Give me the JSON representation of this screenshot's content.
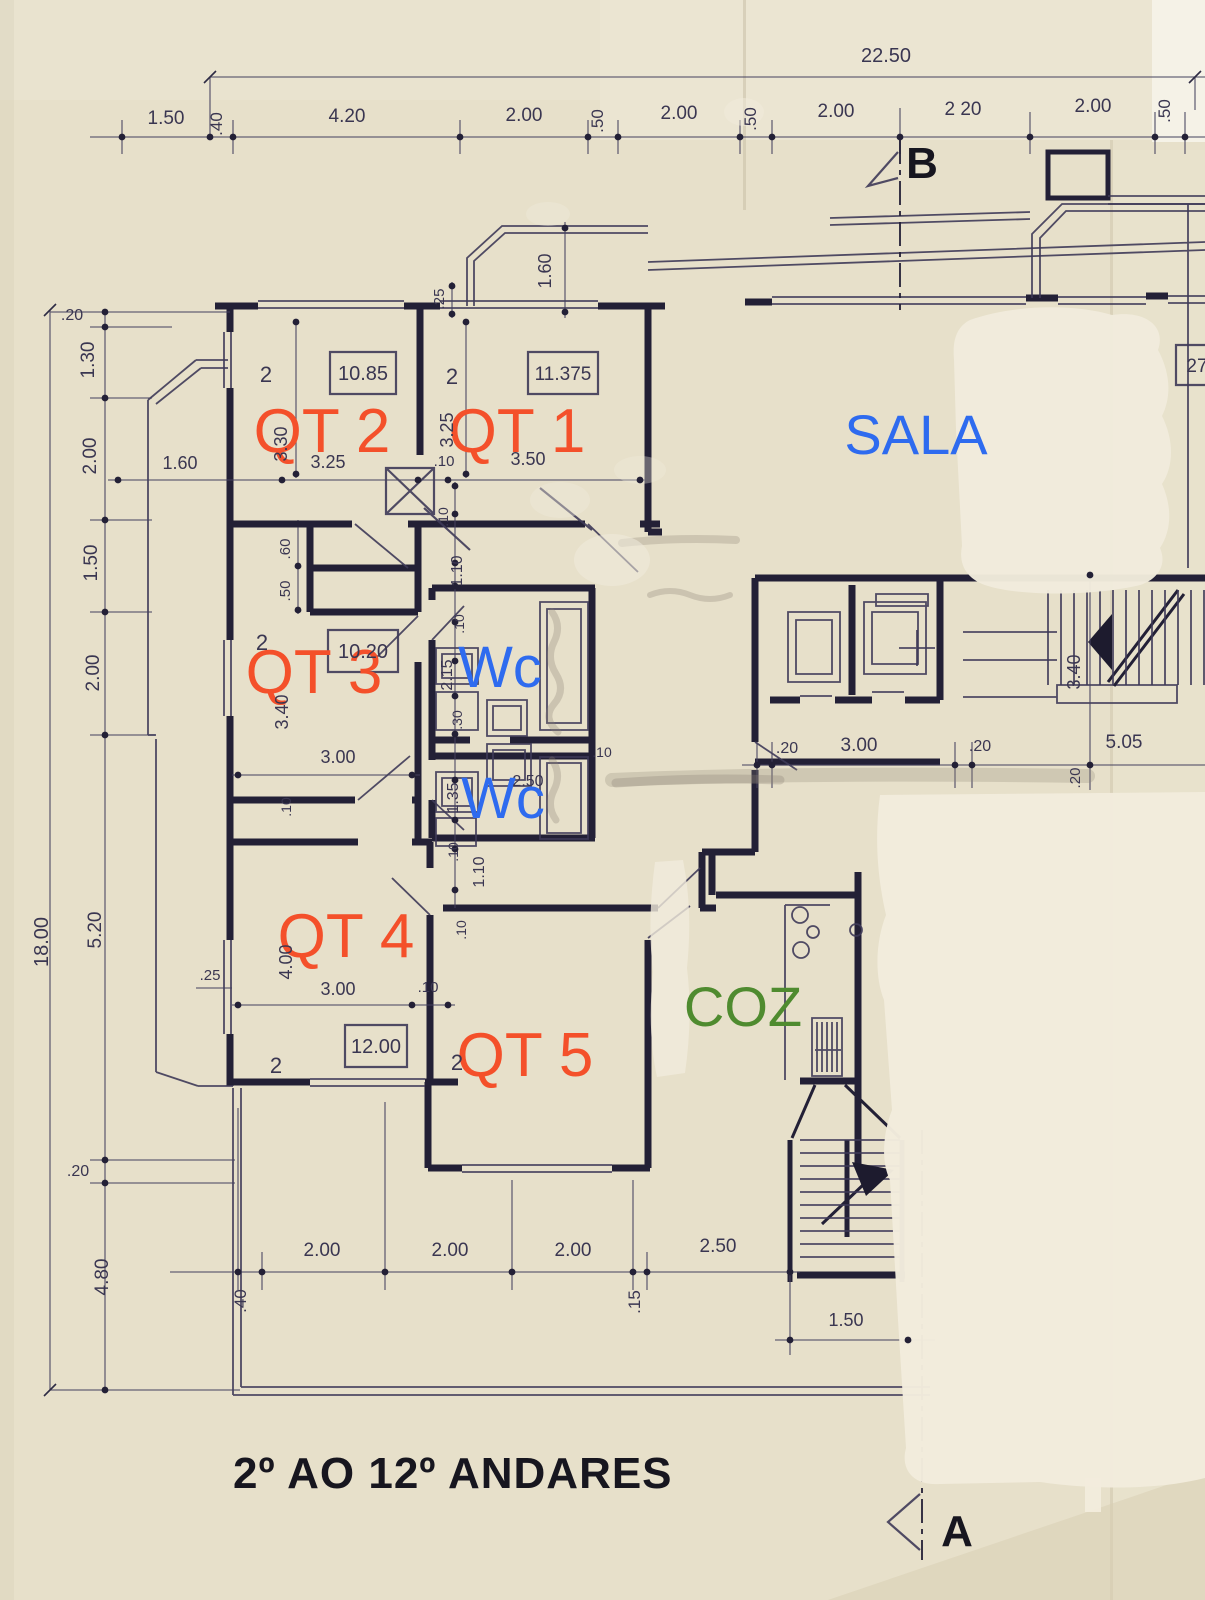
{
  "palette": {
    "paper": "#e7e0ca",
    "paper_light": "#efe9d9",
    "whiteout": "#f1ebdc",
    "ink": "#232036",
    "ink_thin": "#3e3a58",
    "dim_text": "#3a3651",
    "room_accent": "#f4502a",
    "wet_accent": "#2e6bef",
    "kitchen_accent": "#4f8b2f",
    "marker_ink": "#17161f",
    "pencil": "#8b8273"
  },
  "drawing": {
    "floor_range_label": "2º AO 12º ANDARES",
    "section_markers": {
      "top": "B",
      "bottom": "A"
    },
    "overall_dimensions": {
      "width_m": "22.50",
      "height_m": "18.00"
    }
  },
  "rooms": [
    {
      "label": "QT 2",
      "area_m2": "10.85",
      "room_number": "2",
      "label_color": "orange-red"
    },
    {
      "label": "QT 1",
      "area_m2": "11.375",
      "room_number": "2",
      "label_color": "orange-red"
    },
    {
      "label": "SALA",
      "label_color": "blue"
    },
    {
      "label": "QT 3",
      "area_m2": "10.20",
      "room_number": "2",
      "label_color": "orange-red"
    },
    {
      "label": "Wc",
      "label_color": "blue"
    },
    {
      "label": "Wc",
      "label_color": "blue"
    },
    {
      "label": "QT 4",
      "area_m2": "12.00",
      "room_number": "2",
      "label_color": "orange-red"
    },
    {
      "label": "QT 5",
      "room_number": "2",
      "label_color": "orange-red"
    },
    {
      "label": "COZ",
      "label_color": "green"
    }
  ],
  "dimension_strings": {
    "top": [
      "1.50",
      ".40",
      "4.20",
      "2.00",
      ".50",
      "2.00",
      ".50",
      "2.00",
      "2.20",
      "2.00",
      ".50"
    ],
    "left": [
      ".20",
      "1.30",
      "2.00",
      "1.50",
      "2.00",
      "5.20",
      ".20",
      "4.80"
    ],
    "bottom": [
      ".40",
      "2.00",
      "2.00",
      "2.00",
      ".15",
      "2.50",
      "1.50"
    ],
    "middle_right": [
      ".20",
      "3.00",
      ".20",
      "5.05",
      "3.40",
      ".20"
    ]
  },
  "annotations": [
    {
      "text": "QT 2",
      "x": 322,
      "y": 452,
      "s": 62,
      "c": "room_accent",
      "n": "room-label-qt2"
    },
    {
      "text": "QT 1",
      "x": 517,
      "y": 452,
      "s": 62,
      "c": "room_accent",
      "n": "room-label-qt1"
    },
    {
      "text": "SALA",
      "x": 916,
      "y": 454,
      "s": 56,
      "c": "wet_accent",
      "n": "room-label-sala"
    },
    {
      "text": "QT 3",
      "x": 314,
      "y": 693,
      "s": 62,
      "c": "room_accent",
      "n": "room-label-qt3"
    },
    {
      "text": "Wc",
      "x": 500,
      "y": 687,
      "s": 58,
      "c": "wet_accent",
      "n": "room-label-wc-upper"
    },
    {
      "text": "Wc",
      "x": 503,
      "y": 818,
      "s": 58,
      "c": "wet_accent",
      "n": "room-label-wc-lower"
    },
    {
      "text": "QT 4",
      "x": 346,
      "y": 957,
      "s": 62,
      "c": "room_accent",
      "n": "room-label-qt4"
    },
    {
      "text": "QT 5",
      "x": 525,
      "y": 1076,
      "s": 62,
      "c": "room_accent",
      "n": "room-label-qt5"
    },
    {
      "text": "COZ",
      "x": 743,
      "y": 1026,
      "s": 56,
      "c": "kitchen_accent",
      "n": "room-label-coz"
    },
    {
      "text": "2º AO 12º ANDARES",
      "x": 233,
      "y": 1488,
      "s": 44,
      "c": "marker_ink",
      "w": "bold",
      "a": "start",
      "ls": 1,
      "n": "floor-range-label"
    },
    {
      "text": "B",
      "x": 922,
      "y": 178,
      "s": 44,
      "c": "marker_ink",
      "w": "bold",
      "n": "section-marker-b"
    },
    {
      "text": "A",
      "x": 957,
      "y": 1546,
      "s": 44,
      "c": "marker_ink",
      "w": "bold",
      "n": "section-marker-a"
    },
    {
      "text": "10.85",
      "x": 363,
      "y": 380,
      "s": 20,
      "n": "area-value-qt2"
    },
    {
      "text": "11.375",
      "x": 563,
      "y": 380,
      "s": 19,
      "n": "area-value-qt1"
    },
    {
      "text": "10.20",
      "x": 363,
      "y": 658,
      "s": 20,
      "n": "area-value-qt3"
    },
    {
      "text": "12.00",
      "x": 376,
      "y": 1053,
      "s": 20,
      "n": "area-value-qt4"
    },
    {
      "text": "27",
      "x": 1197,
      "y": 372,
      "s": 19,
      "n": "area-value-partial"
    },
    {
      "text": "2",
      "x": 266,
      "y": 382,
      "s": 22,
      "n": "room-number"
    },
    {
      "text": "2",
      "x": 452,
      "y": 384,
      "s": 22,
      "n": "room-number"
    },
    {
      "text": "2",
      "x": 262,
      "y": 650,
      "s": 22,
      "n": "room-number"
    },
    {
      "text": "2",
      "x": 276,
      "y": 1073,
      "s": 22,
      "n": "room-number"
    },
    {
      "text": "2",
      "x": 457,
      "y": 1070,
      "s": 22,
      "n": "room-number"
    },
    {
      "text": "22.50",
      "x": 886,
      "y": 62,
      "s": 20,
      "n": "dimension-label"
    },
    {
      "text": "1.50",
      "x": 166,
      "y": 124,
      "n": "dimension-label"
    },
    {
      "text": ".40",
      "x": 222,
      "y": 124,
      "r": -90,
      "s": 17,
      "n": "dimension-label"
    },
    {
      "text": "4.20",
      "x": 347,
      "y": 122,
      "n": "dimension-label"
    },
    {
      "text": "2.00",
      "x": 524,
      "y": 121,
      "n": "dimension-label"
    },
    {
      "text": ".50",
      "x": 603,
      "y": 121,
      "r": -90,
      "s": 17,
      "n": "dimension-label"
    },
    {
      "text": "2.00",
      "x": 679,
      "y": 119,
      "n": "dimension-label"
    },
    {
      "text": ".50",
      "x": 756,
      "y": 119,
      "r": -90,
      "s": 17,
      "n": "dimension-label"
    },
    {
      "text": "2.00",
      "x": 836,
      "y": 117,
      "n": "dimension-label"
    },
    {
      "text": "2 20",
      "x": 963,
      "y": 115,
      "n": "dimension-label"
    },
    {
      "text": "2.00",
      "x": 1093,
      "y": 112,
      "n": "dimension-label"
    },
    {
      "text": ".50",
      "x": 1170,
      "y": 111,
      "r": -90,
      "s": 17,
      "n": "dimension-label"
    },
    {
      "text": ".20",
      "x": 72,
      "y": 320,
      "s": 16,
      "n": "dimension-label"
    },
    {
      "text": "1.30",
      "x": 94,
      "y": 360,
      "r": -90,
      "n": "dimension-label"
    },
    {
      "text": "2.00",
      "x": 96,
      "y": 456,
      "r": -90,
      "n": "dimension-label"
    },
    {
      "text": "1.50",
      "x": 97,
      "y": 563,
      "r": -90,
      "n": "dimension-label"
    },
    {
      "text": "2.00",
      "x": 99,
      "y": 673,
      "r": -90,
      "n": "dimension-label"
    },
    {
      "text": "5.20",
      "x": 101,
      "y": 930,
      "r": -90,
      "n": "dimension-label"
    },
    {
      "text": ".20",
      "x": 78,
      "y": 1176,
      "s": 16,
      "n": "dimension-label"
    },
    {
      "text": "4.80",
      "x": 108,
      "y": 1277,
      "r": -90,
      "n": "dimension-label"
    },
    {
      "text": "18.00",
      "x": 48,
      "y": 942,
      "r": -90,
      "s": 20,
      "n": "dimension-label"
    },
    {
      "text": ".40",
      "x": 246,
      "y": 1301,
      "r": -90,
      "s": 17,
      "n": "dimension-label"
    },
    {
      "text": "2.00",
      "x": 322,
      "y": 1256,
      "n": "dimension-label"
    },
    {
      "text": "2.00",
      "x": 450,
      "y": 1256,
      "n": "dimension-label"
    },
    {
      "text": "2.00",
      "x": 573,
      "y": 1256,
      "n": "dimension-label"
    },
    {
      "text": ".15",
      "x": 640,
      "y": 1302,
      "r": -90,
      "s": 17,
      "n": "dimension-label"
    },
    {
      "text": "2.50",
      "x": 718,
      "y": 1252,
      "n": "dimension-label"
    },
    {
      "text": "1.50",
      "x": 846,
      "y": 1326,
      "s": 18,
      "n": "dimension-label"
    },
    {
      "text": ".20",
      "x": 787,
      "y": 753,
      "s": 16,
      "n": "dimension-label"
    },
    {
      "text": "3.00",
      "x": 859,
      "y": 751,
      "n": "dimension-label"
    },
    {
      "text": ".20",
      "x": 980,
      "y": 751,
      "s": 16,
      "n": "dimension-label"
    },
    {
      "text": "5.05",
      "x": 1124,
      "y": 748,
      "n": "dimension-label"
    },
    {
      "text": "3.40",
      "x": 1080,
      "y": 672,
      "r": -90,
      "s": 18,
      "n": "dimension-label"
    },
    {
      "text": ".20",
      "x": 1080,
      "y": 778,
      "r": -90,
      "s": 15,
      "n": "dimension-label"
    },
    {
      "text": "1.60",
      "x": 180,
      "y": 469,
      "s": 18,
      "n": "dimension-label"
    },
    {
      "text": "3.25",
      "x": 328,
      "y": 468,
      "s": 18,
      "n": "dimension-label"
    },
    {
      "text": ".10",
      "x": 444,
      "y": 466,
      "s": 15,
      "n": "dimension-label"
    },
    {
      "text": "3.50",
      "x": 528,
      "y": 465,
      "s": 18,
      "n": "dimension-label"
    },
    {
      "text": "3.30",
      "x": 287,
      "y": 444,
      "r": -90,
      "s": 18,
      "n": "dimension-label"
    },
    {
      "text": "3.25",
      "x": 453,
      "y": 430,
      "r": -90,
      "s": 18,
      "n": "dimension-label"
    },
    {
      "text": "1.60",
      "x": 551,
      "y": 271,
      "r": -90,
      "s": 18,
      "n": "dimension-label"
    },
    {
      "text": ".25",
      "x": 444,
      "y": 299,
      "r": -90,
      "s": 15,
      "n": "dimension-label"
    },
    {
      "text": ".60",
      "x": 290,
      "y": 549,
      "r": -90,
      "s": 15,
      "n": "dimension-label"
    },
    {
      "text": ".50",
      "x": 290,
      "y": 591,
      "r": -90,
      "s": 15,
      "n": "dimension-label"
    },
    {
      "text": ".10",
      "x": 448,
      "y": 517,
      "r": -90,
      "s": 14,
      "n": "dimension-label"
    },
    {
      "text": "1.10",
      "x": 462,
      "y": 571,
      "r": -90,
      "s": 16,
      "n": "dimension-label"
    },
    {
      "text": ".10",
      "x": 464,
      "y": 624,
      "r": -90,
      "s": 14,
      "n": "dimension-label"
    },
    {
      "text": "2.15",
      "x": 452,
      "y": 675,
      "r": -90,
      "s": 16,
      "n": "dimension-label"
    },
    {
      "text": ".30",
      "x": 462,
      "y": 720,
      "r": -90,
      "s": 14,
      "n": "dimension-label"
    },
    {
      "text": "2.50",
      "x": 528,
      "y": 786,
      "s": 16,
      "n": "dimension-label"
    },
    {
      "text": "1.35",
      "x": 458,
      "y": 798,
      "r": -90,
      "s": 16,
      "n": "dimension-label"
    },
    {
      "text": ".10",
      "x": 458,
      "y": 852,
      "r": -90,
      "s": 14,
      "n": "dimension-label"
    },
    {
      "text": "1.10",
      "x": 484,
      "y": 872,
      "r": -90,
      "s": 16,
      "n": "dimension-label"
    },
    {
      "text": ".10",
      "x": 602,
      "y": 757,
      "s": 14,
      "n": "dimension-label"
    },
    {
      "text": "3.40",
      "x": 288,
      "y": 712,
      "r": -90,
      "s": 18,
      "n": "dimension-label"
    },
    {
      "text": "3.00",
      "x": 338,
      "y": 763,
      "s": 18,
      "n": "dimension-label"
    },
    {
      "text": ".10",
      "x": 291,
      "y": 807,
      "r": -90,
      "s": 14,
      "n": "dimension-label"
    },
    {
      "text": "4.00",
      "x": 292,
      "y": 962,
      "r": -90,
      "s": 18,
      "n": "dimension-label"
    },
    {
      "text": "3.00",
      "x": 338,
      "y": 995,
      "s": 18,
      "n": "dimension-label"
    },
    {
      "text": ".10",
      "x": 428,
      "y": 992,
      "s": 15,
      "n": "dimension-label"
    },
    {
      "text": ".25",
      "x": 210,
      "y": 980,
      "s": 15,
      "n": "dimension-label"
    },
    {
      "text": ".10",
      "x": 466,
      "y": 930,
      "r": -90,
      "s": 14,
      "n": "dimension-label"
    }
  ]
}
